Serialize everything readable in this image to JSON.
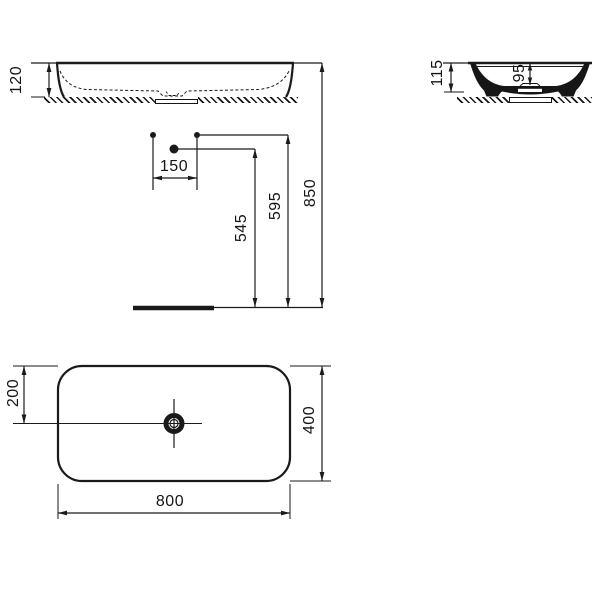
{
  "drawing": {
    "title": "washbasin-technical-drawing",
    "line_color": "#1a1a1a",
    "background_color": "#ffffff",
    "front_view": {
      "height": "120"
    },
    "side_view": {
      "height": "115",
      "inner_depth": "95"
    },
    "installation_view": {
      "hole_spacing": "150",
      "tap_hole_height": "545",
      "fixing_hole_height": "595",
      "rim_height": "850"
    },
    "plan_view": {
      "drain_offset": "200",
      "width": "800",
      "depth": "400"
    }
  }
}
